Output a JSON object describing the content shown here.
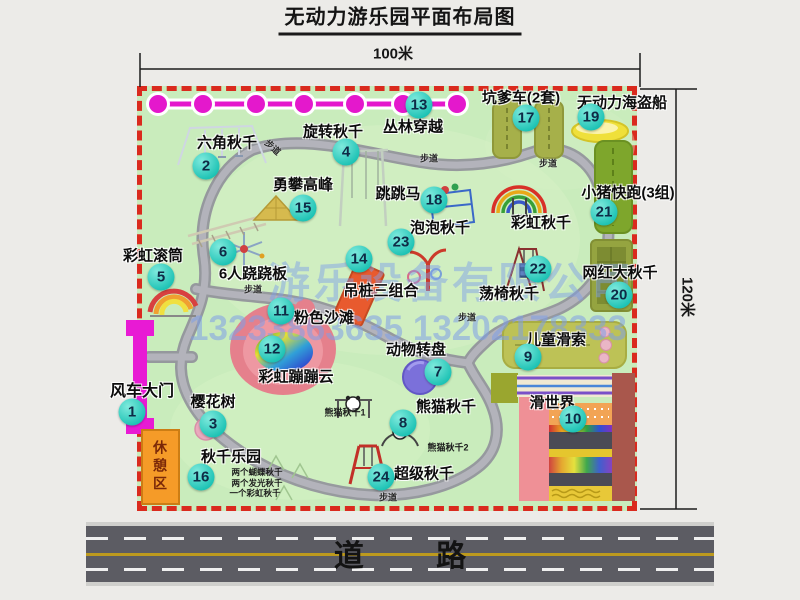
{
  "title": "无动力游乐园平面布局图",
  "dimensions": {
    "top": "100米",
    "right": "120米"
  },
  "watermark": {
    "company": "游乐设备有限公司",
    "phones": "13233863635 13202178333"
  },
  "road": {
    "label": "道 路"
  },
  "trail_label": "步道",
  "rainbow_swing_label": "彩虹秋千",
  "rest_area_label": "休憩区",
  "panda_notes": [
    "熊猫秋千1",
    "熊猫秋千2"
  ],
  "swing_park_notes": [
    "两个蝴蝶秋千",
    "两个发光秋千",
    "一个彩虹秋千"
  ],
  "facilities": [
    {
      "num": "1",
      "name": "风车大门"
    },
    {
      "num": "2",
      "name": "六角秋千"
    },
    {
      "num": "3",
      "name": "樱花树"
    },
    {
      "num": "4",
      "name": "旋转秋千"
    },
    {
      "num": "5",
      "name": "彩虹滚筒"
    },
    {
      "num": "6",
      "name": "6人跷跷板"
    },
    {
      "num": "7",
      "name": "动物转盘"
    },
    {
      "num": "8",
      "name": "熊猫秋千"
    },
    {
      "num": "9",
      "name": "儿童滑索"
    },
    {
      "num": "10",
      "name": "滑世界"
    },
    {
      "num": "11",
      "name": "粉色沙滩"
    },
    {
      "num": "12",
      "name": "彩虹蹦蹦云"
    },
    {
      "num": "13",
      "name": "丛林穿越"
    },
    {
      "num": "14",
      "name": "吊桩三组合"
    },
    {
      "num": "15",
      "name": "勇攀高峰"
    },
    {
      "num": "16",
      "name": "秋千乐园"
    },
    {
      "num": "17",
      "name": "坑爹车(2套)"
    },
    {
      "num": "18",
      "name": "跳跳马"
    },
    {
      "num": "19",
      "name": "无动力海盗船"
    },
    {
      "num": "20",
      "name": "网红大秋千"
    },
    {
      "num": "21",
      "name": "小猪快跑(3组)"
    },
    {
      "num": "22",
      "name": "荡椅秋千"
    },
    {
      "num": "23",
      "name": "泡泡秋千"
    },
    {
      "num": "24",
      "name": "超级秋千"
    }
  ]
}
